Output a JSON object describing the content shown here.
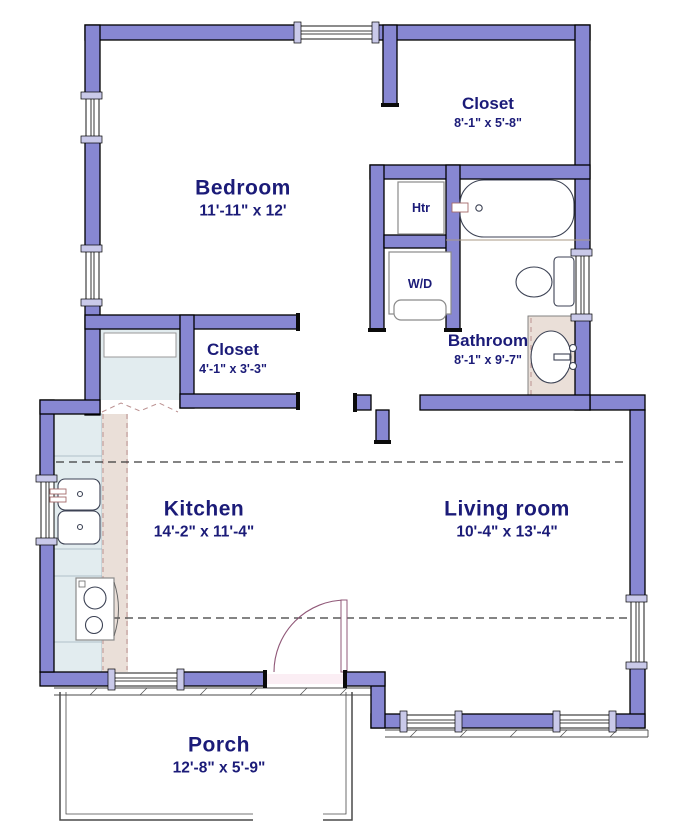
{
  "title": "Floor plan",
  "colors": {
    "wall": "#8787D2",
    "window_trim": "#C9C9E9",
    "label_text": "#1B1B78",
    "counter": "#E2ECEF",
    "floor_strip": "#EADFD8",
    "clearance_dash": "#BB9090",
    "fixture_outline": "#3C4254"
  },
  "rooms": [
    {
      "id": "bedroom",
      "name": "Bedroom",
      "dims": "11'-11\" x 12'"
    },
    {
      "id": "closet-top",
      "name": "Closet",
      "dims": "8'-1\" x 5'-8\""
    },
    {
      "id": "closet-small",
      "name": "Closet",
      "dims": "4'-1\" x 3'-3\""
    },
    {
      "id": "bathroom",
      "name": "Bathroom",
      "dims": "8'-1\" x 9'-7\""
    },
    {
      "id": "kitchen",
      "name": "Kitchen",
      "dims": "14'-2\" x 11'-4\""
    },
    {
      "id": "living-room",
      "name": "Living room",
      "dims": "10'-4\" x 13'-4\""
    },
    {
      "id": "porch",
      "name": "Porch",
      "dims": "12'-8\" x 5'-9\""
    }
  ],
  "fixtures": [
    {
      "id": "heater",
      "label": "Htr"
    },
    {
      "id": "washer-dryer",
      "label": "W/D"
    }
  ]
}
